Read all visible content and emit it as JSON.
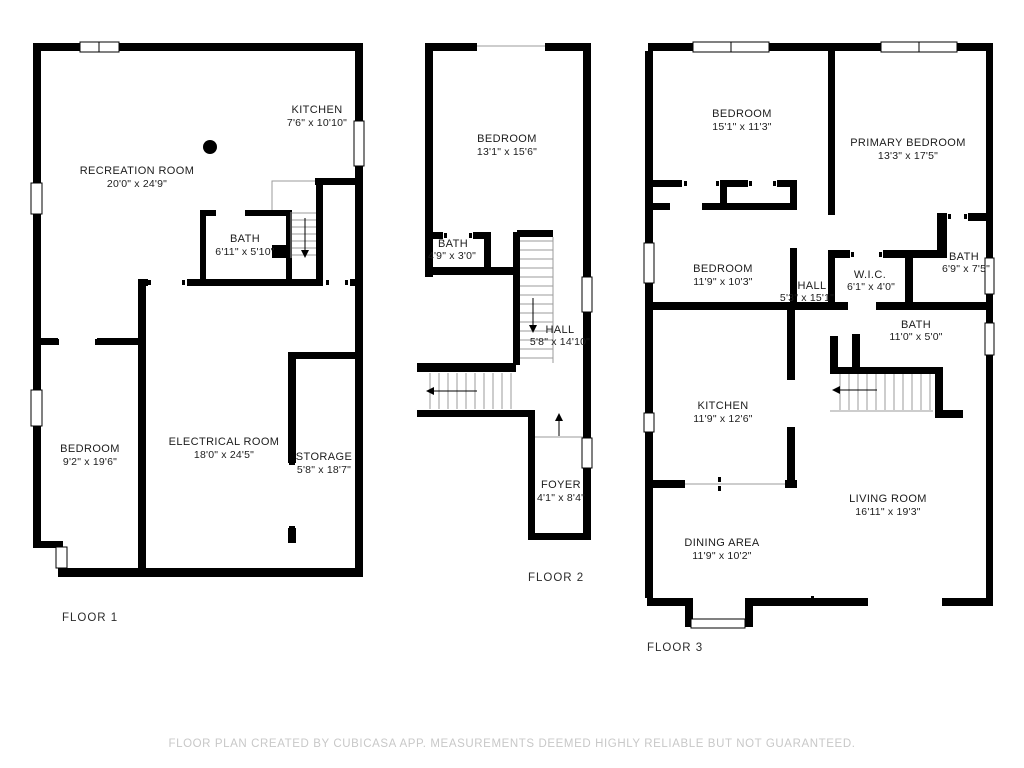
{
  "colors": {
    "wall": "#000000",
    "label": "#1c1c1c",
    "stair_line": "#9b9b9b",
    "footer": "#c8c8c8"
  },
  "footer": {
    "text": "FLOOR PLAN CREATED BY CUBICASA APP. MEASUREMENTS DEEMED HIGHLY RELIABLE BUT NOT GUARANTEED."
  },
  "floors": [
    {
      "label": "FLOOR 1",
      "rooms": [
        {
          "name": "KITCHEN",
          "dims": "7'6\" x 10'10\""
        },
        {
          "name": "RECREATION ROOM",
          "dims": "20'0\" x 24'9\""
        },
        {
          "name": "BATH",
          "dims": "6'11\" x 5'10\""
        },
        {
          "name": "BEDROOM",
          "dims": "9'2\" x 19'6\""
        },
        {
          "name": "ELECTRICAL ROOM",
          "dims": "18'0\" x 24'5\""
        },
        {
          "name": "STORAGE",
          "dims": "5'8\" x 18'7\""
        }
      ]
    },
    {
      "label": "FLOOR 2",
      "rooms": [
        {
          "name": "BEDROOM",
          "dims": "13'1\" x 15'6\""
        },
        {
          "name": "BATH",
          "dims": "4'9\" x 3'0\""
        },
        {
          "name": "HALL",
          "dims": "5'8\" x 14'10\""
        },
        {
          "name": "FOYER",
          "dims": "4'1\" x 8'4\""
        }
      ]
    },
    {
      "label": "FLOOR 3",
      "rooms": [
        {
          "name": "BEDROOM",
          "dims": "15'1\" x 11'3\""
        },
        {
          "name": "PRIMARY BEDROOM",
          "dims": "13'3\" x 17'5\""
        },
        {
          "name": "BEDROOM",
          "dims": "11'9\" x 10'3\""
        },
        {
          "name": "HALL",
          "dims": "5'3\" x 15'1\""
        },
        {
          "name": "W.I.C.",
          "dims": "6'1\" x 4'0\""
        },
        {
          "name": "BATH",
          "dims": "6'9\" x 7'5\""
        },
        {
          "name": "BATH",
          "dims": "11'0\" x 5'0\""
        },
        {
          "name": "KITCHEN",
          "dims": "11'9\" x 12'6\""
        },
        {
          "name": "LIVING ROOM",
          "dims": "16'11\" x 19'3\""
        },
        {
          "name": "DINING AREA",
          "dims": "11'9\" x 10'2\""
        }
      ]
    }
  ]
}
